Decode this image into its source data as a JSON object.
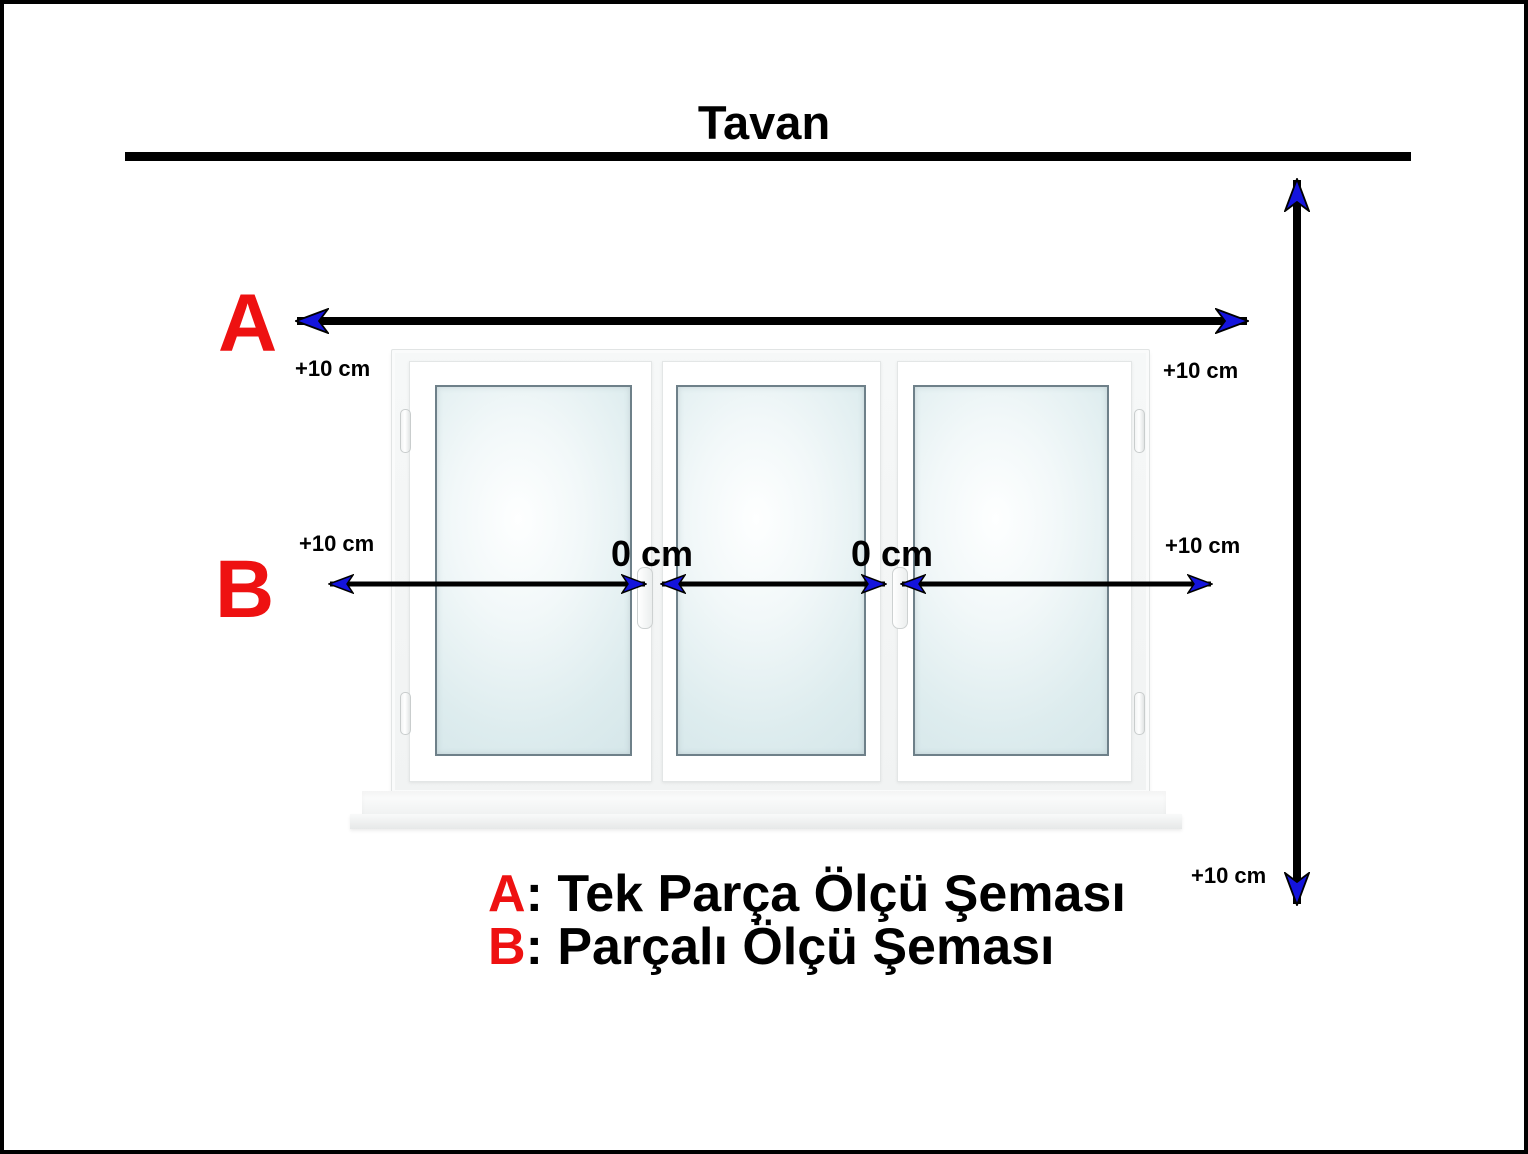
{
  "title": "Tavan",
  "scheme_labels": {
    "a": "A",
    "b": "B"
  },
  "measurements": {
    "top_left": "+10 cm",
    "mid_left": "+10 cm",
    "top_right": "+10 cm",
    "mid_right": "+10 cm",
    "bottom_right": "+10 cm",
    "gap_1": "0 cm",
    "gap_2": "0 cm"
  },
  "legend": {
    "a_key": "A",
    "a_text": ": Tek Parça Ölçü Şeması",
    "b_key": "B",
    "b_text": ": Parçalı Ölçü Şeması"
  },
  "colors": {
    "accent_red": "#ee1111",
    "arrow_blue": "#1414dd",
    "line_black": "#000000"
  }
}
